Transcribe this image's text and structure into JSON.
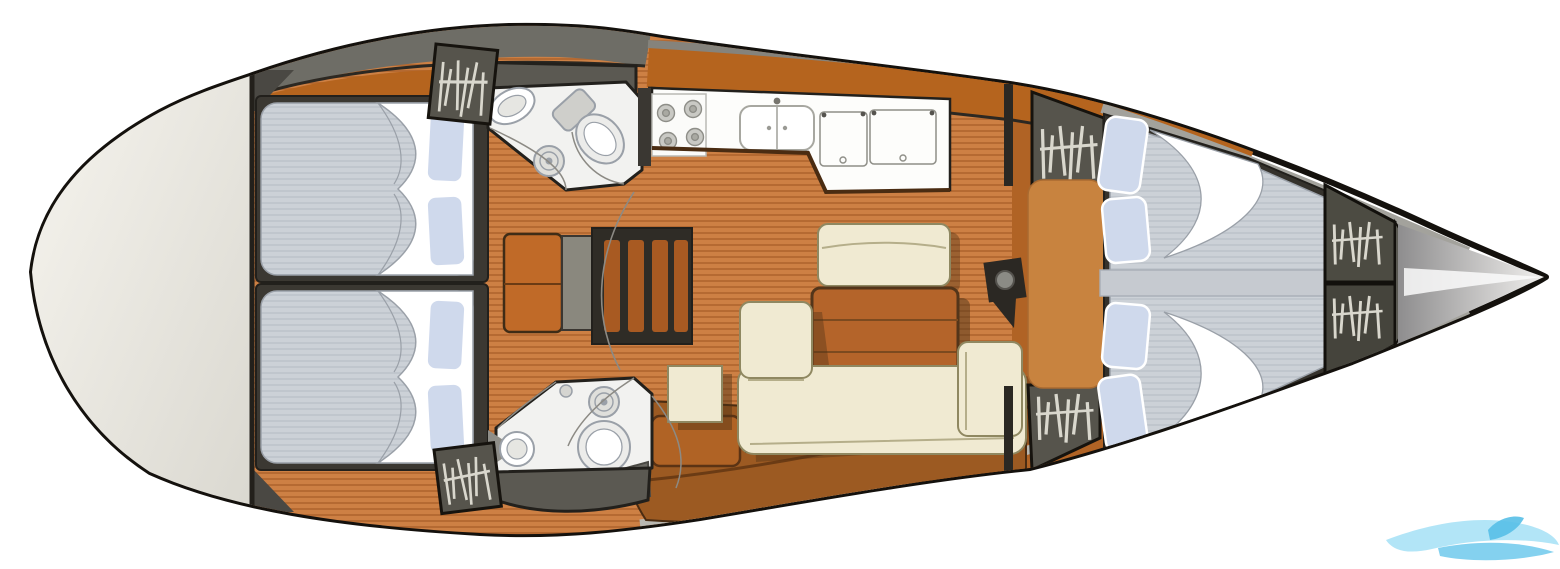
{
  "canvas": {
    "width": 1560,
    "height": 569,
    "background": "#ffffff"
  },
  "diagram": {
    "type": "sailing-yacht-interior-floor-plan",
    "orientation": "bow-right-stern-left",
    "watermark_shape": "blue-wave-swoosh"
  },
  "colors": {
    "hull_outline": "#14110d",
    "hull_fill": "#ffffff",
    "deck_light": "#f8f6f0",
    "deck_dark": "#d9d7cf",
    "bow_dark": "#8e8d8e",
    "bow_light": "#f0efed",
    "deck_strip": "#a3a29c",
    "floor_base": "#cd8044",
    "floor_stripe": "#b56a32",
    "top_band": "#b5641e",
    "side_band": "#6e6d66",
    "cabinet": "#9c5a22",
    "cabinet_door": "#b06325",
    "door": "#c8833f",
    "table": "#b4642a",
    "table_border": "#53351a",
    "sofa": "#f0ead2",
    "sofa_outline": "#8f8861",
    "sofa_seam": "#b5ae8a",
    "shadow": "#503317",
    "mattress_base": "#ccd1d7",
    "mattress_stripe": "#bdc3cb",
    "mattress_edge": "#9aa0a8",
    "berth_frame": "#3b3832",
    "pillow": "#cfd9ec",
    "sheet": "#ffffff",
    "locker": "#56544c",
    "locker_outline": "#16130e",
    "hanger": "#d9d7cd",
    "fixture": "#f2f2f0",
    "fixture_stroke": "#9aa0a8",
    "counter_dark": "#5b5952",
    "line_dark": "#22201c",
    "steps": "#a85a22",
    "steps_frame": "#2f2c26",
    "nav_table": "#c06a28",
    "gray_strip": "#8a887e",
    "mast": "#2b2823",
    "mast_circle": "#8b8b85",
    "burner": "#c9c9c4",
    "arc": "#8c8a84",
    "wm_light": "#a5e0f6",
    "wm_mid": "#6fc9ec",
    "wm_dark": "#57bfe7"
  },
  "inventory": {
    "aft_double_cabins": 2,
    "forward_v_berth_cabins": 1,
    "heads_with_shower": 2,
    "galley_stove_burners": 4,
    "galley_sink_bowls": 2,
    "galley_top_loading_lockers": 2,
    "hanging_lockers": 6,
    "salon_sofa": "L-shaped",
    "salon_tables": 1,
    "salon_benches": 1,
    "nav_chart_tables": 1,
    "companionway_steps": 1,
    "mast_posts": 1
  }
}
